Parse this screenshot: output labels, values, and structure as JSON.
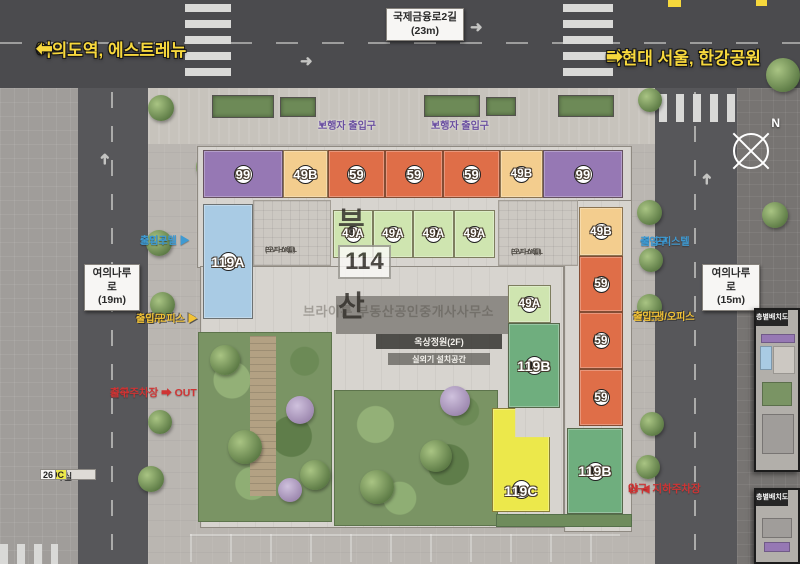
{
  "colors": {
    "49A": "#cfe5b0",
    "49B": "#f3cd8e",
    "59": "#df6e48",
    "99": "#9678b4",
    "119A": "#a9cbe4",
    "119B": "#6fae7e",
    "119C": "#ece84b"
  },
  "header": {
    "dir_left_arrow": "⬅",
    "dir_left": "여의도역, 에스트레뉴",
    "dir_right": "더현대 서울, 한강공원",
    "dir_right_arrow": "➡",
    "road_top_name": "국제금융로2길",
    "road_top_width": "(23m)",
    "road_left_name": "여의나루로",
    "road_left_width": "(19m)",
    "road_right_name": "여의나루로",
    "road_right_width": "(15m)",
    "compass_n": "N"
  },
  "labels": {
    "pedestrian": "보행자 출입구",
    "pedestrian_arrow": "▼",
    "officetel_left_1": "오피스텔 ▶",
    "officetel_left_2": "출입구",
    "officetel_right_1": "◀ 오피스텔",
    "officetel_right_2": "출입구",
    "retail_left_1": "근생/오피스 ▶",
    "retail_left_2": "출입구",
    "retail_right_1": "◀ 근생/오피스",
    "retail_right_2": "출입구",
    "parking_out_1": "지하주차장 ➡ OUT",
    "parking_out_2": "출구",
    "parking_in_1": "IN ◀ 지하주차장",
    "parking_in_2": "입구"
  },
  "building": {
    "ev_hall": "E/V HALL",
    "ev_hall_sub": "(오피스텔)",
    "roof_garden": "옥상정원(2F)",
    "outdoor_unit": "실외기 설치공간"
  },
  "watermark": {
    "brand": "부동산",
    "logo": "114",
    "subtitle": "브라이튼 부동산공인중개사사무소"
  },
  "units": [
    {
      "no": "1",
      "type": "119A",
      "x": 203,
      "y": 204,
      "w": 50,
      "h": 115
    },
    {
      "no": "2",
      "type": "99",
      "x": 203,
      "y": 150,
      "w": 80,
      "h": 48
    },
    {
      "no": "3",
      "type": "49B",
      "x": 283,
      "y": 150,
      "w": 45,
      "h": 48
    },
    {
      "no": "4",
      "type": "59",
      "x": 328,
      "y": 150,
      "w": 57,
      "h": 48
    },
    {
      "no": "5",
      "type": "59",
      "x": 385,
      "y": 150,
      "w": 58,
      "h": 48
    },
    {
      "no": "6",
      "type": "59",
      "x": 443,
      "y": 150,
      "w": 57,
      "h": 48
    },
    {
      "no": "7",
      "type": "49B",
      "x": 500,
      "y": 150,
      "w": 43,
      "h": 48
    },
    {
      "no": "8",
      "type": "99",
      "x": 543,
      "y": 150,
      "w": 80,
      "h": 48
    },
    {
      "no": "9",
      "type": "49A",
      "x": 333,
      "y": 210,
      "w": 40,
      "h": 48
    },
    {
      "no": "10",
      "type": "49A",
      "x": 373,
      "y": 210,
      "w": 40,
      "h": 48
    },
    {
      "no": "11",
      "type": "49A",
      "x": 413,
      "y": 210,
      "w": 41,
      "h": 48
    },
    {
      "no": "12",
      "type": "49A",
      "x": 454,
      "y": 210,
      "w": 41,
      "h": 48
    },
    {
      "no": "13",
      "type": "49B",
      "x": 579,
      "y": 207,
      "w": 44,
      "h": 49
    },
    {
      "no": "14",
      "type": "59",
      "x": 579,
      "y": 256,
      "w": 44,
      "h": 56
    },
    {
      "no": "15",
      "type": "59",
      "x": 579,
      "y": 312,
      "w": 44,
      "h": 57
    },
    {
      "no": "16",
      "type": "59",
      "x": 579,
      "y": 369,
      "w": 44,
      "h": 57
    },
    {
      "no": "17",
      "type": "119B",
      "x": 567,
      "y": 428,
      "w": 56,
      "h": 86
    },
    {
      "no": "18",
      "type": "119C",
      "x": 492,
      "y": 408,
      "w": 58,
      "h": 104,
      "clip": true
    },
    {
      "no": "19",
      "type": "119B",
      "x": 508,
      "y": 323,
      "w": 52,
      "h": 85
    },
    {
      "no": "20",
      "type": "49A",
      "x": 508,
      "y": 285,
      "w": 43,
      "h": 38
    }
  ],
  "table": {
    "headers": [
      "타입",
      "실"
    ],
    "rows": [
      {
        "type": "49A",
        "count": "114"
      },
      {
        "type": "49B",
        "count": "78"
      },
      {
        "type": "59",
        "count": "144"
      },
      {
        "type": "99",
        "count": "52"
      },
      {
        "type": "119A",
        "count": "26"
      },
      {
        "type": "119B",
        "count": "52"
      },
      {
        "type": "119C",
        "count": "26"
      }
    ]
  },
  "panels": [
    {
      "title": "층별배치도"
    },
    {
      "title": "층별배치도"
    }
  ]
}
